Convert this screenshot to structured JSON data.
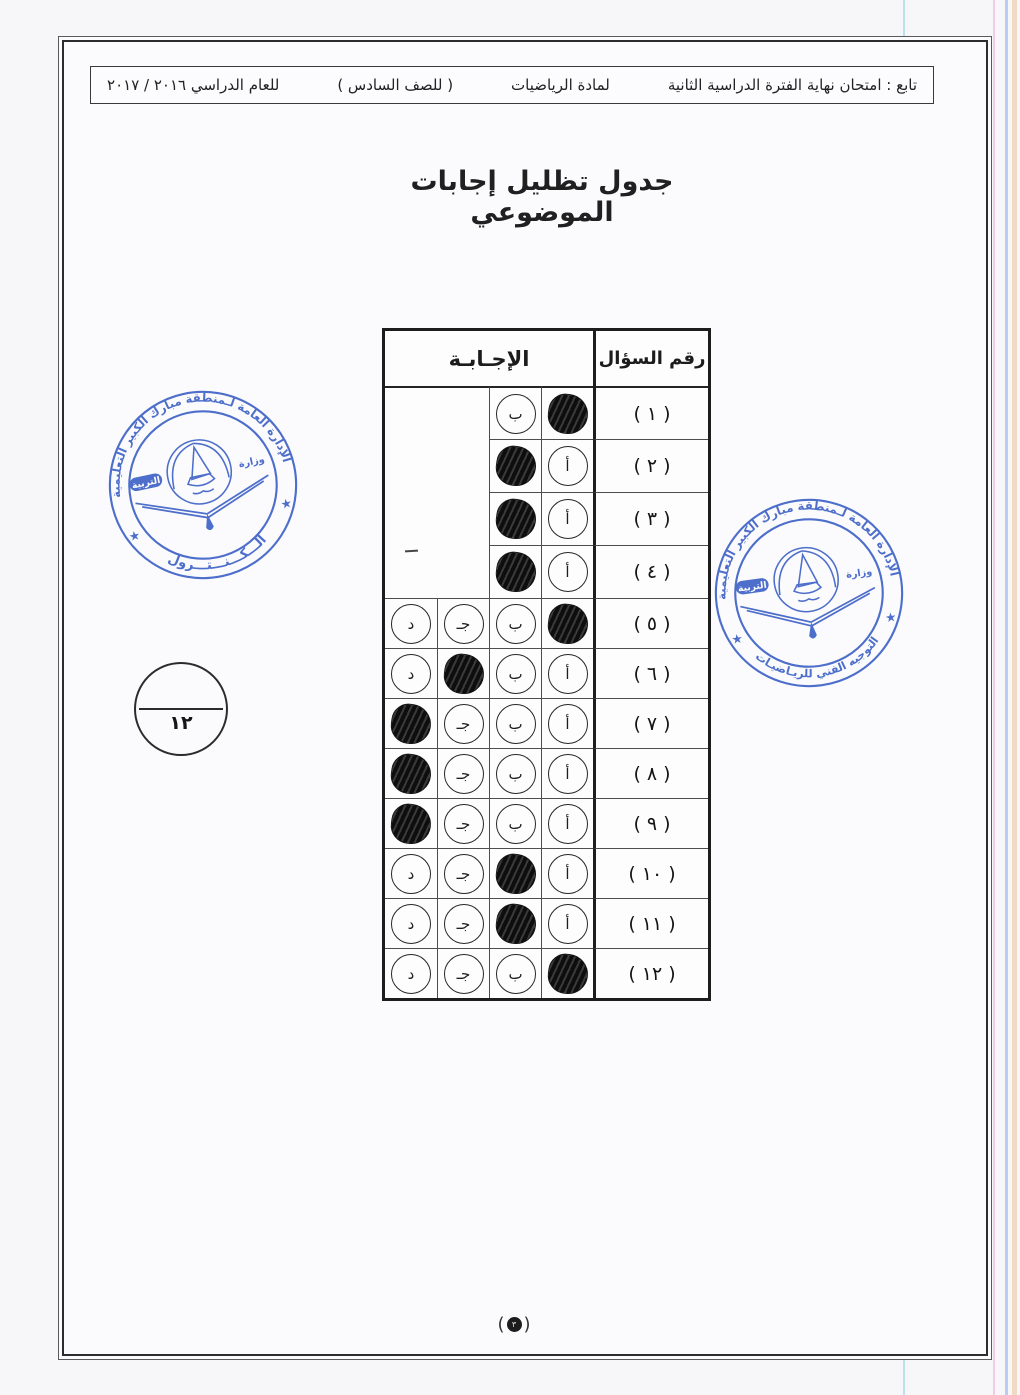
{
  "header": {
    "segments": [
      "تابع : امتحان نهاية الفترة الدراسية الثانية",
      "لمادة الرياضيات",
      "( للصف السادس )",
      "للعام الدراسي ٢٠١٦ / ٢٠١٧"
    ]
  },
  "title": "جدول تظليل إجابات الموضوعي",
  "answer_table": {
    "answer_header": "الإجـابـة",
    "question_header": "رقم السؤال",
    "rows": [
      {
        "label": "( ١ )",
        "answer": "أ",
        "bubbles": [
          {
            "letter": "أ",
            "filled": true
          },
          {
            "letter": "ب",
            "filled": false
          }
        ]
      },
      {
        "label": "( ٢ )",
        "answer": "ب",
        "bubbles": [
          {
            "letter": "أ",
            "filled": false
          },
          {
            "letter": "ب",
            "filled": true
          }
        ]
      },
      {
        "label": "( ٣ )",
        "answer": "ب",
        "bubbles": [
          {
            "letter": "أ",
            "filled": false
          },
          {
            "letter": "ب",
            "filled": true
          }
        ]
      },
      {
        "label": "( ٤ )",
        "answer": "ب",
        "bubbles": [
          {
            "letter": "أ",
            "filled": false
          },
          {
            "letter": "ب",
            "filled": true
          }
        ]
      },
      {
        "label": "( ٥ )",
        "answer": "أ",
        "bubbles": [
          {
            "letter": "أ",
            "filled": true
          },
          {
            "letter": "ب",
            "filled": false
          },
          {
            "letter": "جـ",
            "filled": false
          },
          {
            "letter": "د",
            "filled": false
          }
        ]
      },
      {
        "label": "( ٦ )",
        "answer": "جـ",
        "bubbles": [
          {
            "letter": "أ",
            "filled": false
          },
          {
            "letter": "ب",
            "filled": false
          },
          {
            "letter": "جـ",
            "filled": true
          },
          {
            "letter": "د",
            "filled": false
          }
        ]
      },
      {
        "label": "( ٧ )",
        "answer": "د",
        "bubbles": [
          {
            "letter": "أ",
            "filled": false
          },
          {
            "letter": "ب",
            "filled": false
          },
          {
            "letter": "جـ",
            "filled": false
          },
          {
            "letter": "د",
            "filled": true
          }
        ]
      },
      {
        "label": "( ٨ )",
        "answer": "د",
        "bubbles": [
          {
            "letter": "أ",
            "filled": false
          },
          {
            "letter": "ب",
            "filled": false
          },
          {
            "letter": "جـ",
            "filled": false
          },
          {
            "letter": "د",
            "filled": true
          }
        ]
      },
      {
        "label": "( ٩ )",
        "answer": "د",
        "bubbles": [
          {
            "letter": "أ",
            "filled": false
          },
          {
            "letter": "ب",
            "filled": false
          },
          {
            "letter": "جـ",
            "filled": false
          },
          {
            "letter": "د",
            "filled": true
          }
        ]
      },
      {
        "label": "( ١٠ )",
        "answer": "ب",
        "bubbles": [
          {
            "letter": "أ",
            "filled": false
          },
          {
            "letter": "ب",
            "filled": true
          },
          {
            "letter": "جـ",
            "filled": false
          },
          {
            "letter": "د",
            "filled": false
          }
        ]
      },
      {
        "label": "( ١١ )",
        "answer": "ب",
        "bubbles": [
          {
            "letter": "أ",
            "filled": false
          },
          {
            "letter": "ب",
            "filled": true
          },
          {
            "letter": "جـ",
            "filled": false
          },
          {
            "letter": "د",
            "filled": false
          }
        ]
      },
      {
        "label": "( ١٢ )",
        "answer": "أ",
        "bubbles": [
          {
            "letter": "أ",
            "filled": true
          },
          {
            "letter": "ب",
            "filled": false
          },
          {
            "letter": "جـ",
            "filled": false
          },
          {
            "letter": "د",
            "filled": false
          }
        ]
      }
    ]
  },
  "grade_circle": {
    "score": "١٢"
  },
  "page_number": {
    "open": "(",
    "value": "٣",
    "close": ")"
  },
  "stamps": {
    "color": "#3f63c6",
    "left": {
      "top_text": "الإدارة العامة لـمنطقة مبارك الكبير التعليمية",
      "bottom_text": "الـــكـــنـــتـــرول",
      "ministry": "وزارة",
      "education": "التربية",
      "star": "★"
    },
    "right": {
      "top_text": "الإدارة العامة لـمنطقة مبارك الكبير التعليمية",
      "bottom_text": "التوجيه الفني للريـاضيـات",
      "ministry": "وزارة",
      "education": "التربية",
      "star": "★"
    }
  },
  "colors": {
    "stamp_blue": "#3f63c6",
    "ink": "#1c1c1c",
    "paper": "#fbfbfd"
  }
}
